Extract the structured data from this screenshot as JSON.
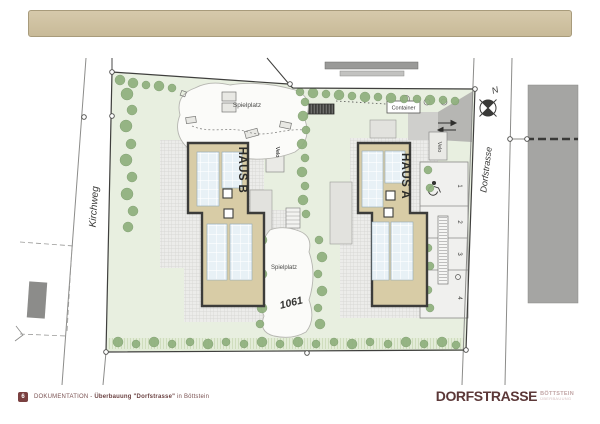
{
  "plan": {
    "street_west": "Kirchweg",
    "street_east": "Dorfstrasse",
    "north": "N",
    "haus_a": "HAUS A",
    "haus_b": "HAUS B",
    "playground_top": "Spielplatz",
    "playground_center": "Spielplatz",
    "parcel_number": "1061",
    "container": "Container",
    "velo_a": "Velo",
    "velo_b": "Velo",
    "parking_spaces": [
      "1",
      "2",
      "3",
      "4"
    ],
    "colors": {
      "lawn": "#e8efe0",
      "hedge": "#8fb07d",
      "roof": "#d8cca6",
      "panel": "#e8f1f6",
      "neighbor_building": "#a5a5a3",
      "header_bar": "#cfc1a1",
      "brand_red": "#5c3838"
    }
  },
  "footer": {
    "page_number": "6",
    "doc_title_prefix": "DOKUMENTATION - ",
    "doc_title_bold": "Überbauung \"Dorfstrasse\"",
    "doc_title_suffix": " in Böttstein",
    "brand_name": "DORFSTRASSE",
    "brand_location": "BÖTTSTEIN",
    "brand_subline": "ÜBERBAUUNG"
  }
}
